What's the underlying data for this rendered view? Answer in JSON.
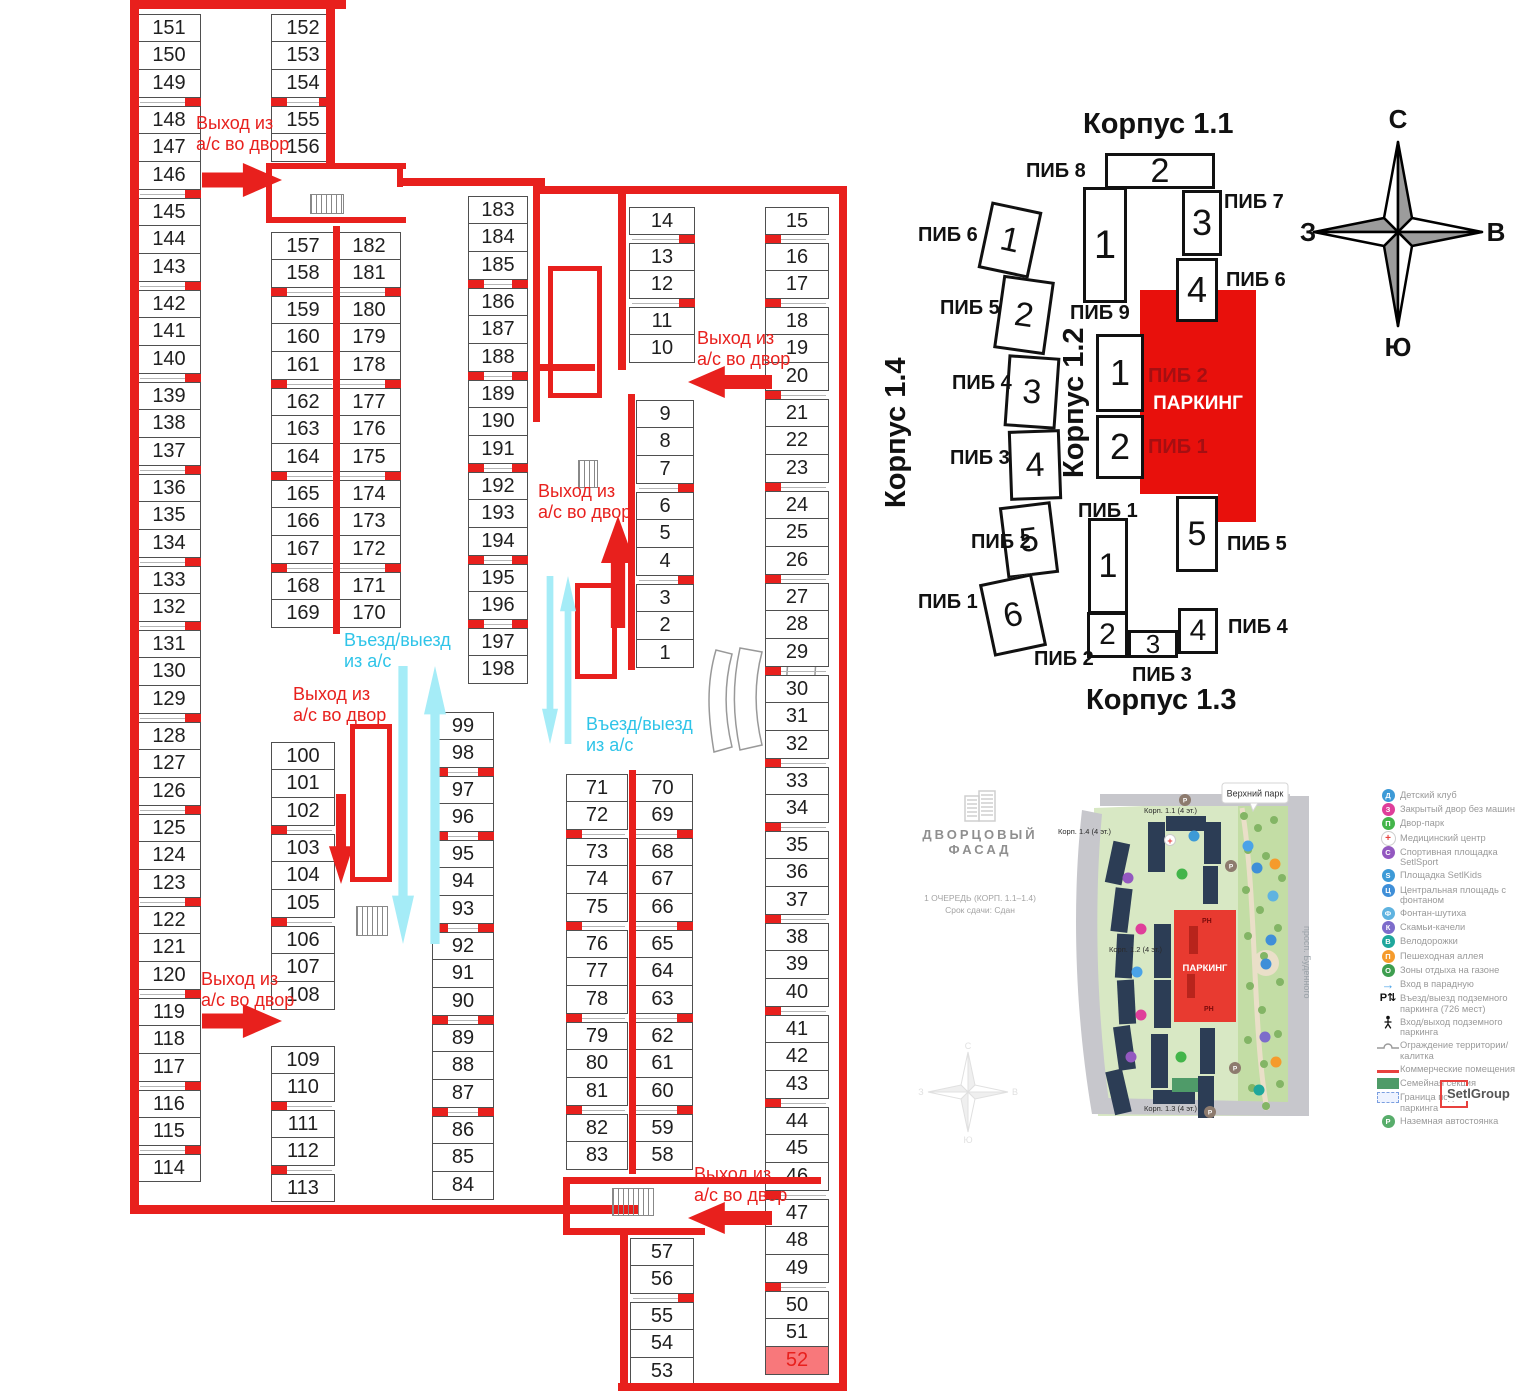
{
  "colors": {
    "wall_red": "#e8201d",
    "cyan_text": "#2fc4e8",
    "cyan_fill": "#a5ecf7",
    "highlight_bg": "#f8787b"
  },
  "floor_plan": {
    "exit_text": "Выход из\nа/с во двор",
    "entry_text": "Въезд/выезд\nиз а/с",
    "highlight": "52",
    "columns": [
      {
        "x": 137,
        "y": 14,
        "w": 64,
        "t": "right",
        "groups": [
          [
            151,
            150,
            149
          ],
          [
            148,
            147,
            146
          ],
          [
            145,
            144,
            143
          ],
          [
            142,
            141,
            140
          ],
          [
            139,
            138,
            137
          ],
          [
            136,
            135,
            134
          ],
          [
            133,
            132
          ],
          [
            131,
            130,
            129
          ],
          [
            128,
            127,
            126
          ],
          [
            125,
            124,
            123
          ],
          [
            122,
            121,
            120
          ],
          [
            119,
            118,
            117
          ],
          [
            116,
            115
          ],
          [
            114
          ]
        ]
      },
      {
        "x": 271,
        "y": 14,
        "w": 64,
        "t": "both",
        "groups": [
          [
            152,
            153,
            154
          ],
          [
            155,
            156
          ]
        ]
      },
      {
        "x": 271,
        "y": 232,
        "w": 64,
        "t": "left",
        "groups": [
          [
            157,
            158
          ],
          [
            159,
            160,
            161
          ],
          [
            162,
            163,
            164
          ],
          [
            165,
            166,
            167
          ],
          [
            168,
            169
          ]
        ]
      },
      {
        "x": 337,
        "y": 232,
        "w": 64,
        "t": "right",
        "groups": [
          [
            182,
            181
          ],
          [
            180,
            179,
            178
          ],
          [
            177,
            176,
            175
          ],
          [
            174,
            173,
            172
          ],
          [
            171,
            170
          ]
        ]
      },
      {
        "x": 271,
        "y": 742,
        "w": 64,
        "t": "left",
        "groups": [
          [
            100,
            101,
            102
          ],
          [
            103,
            104,
            105
          ],
          [
            106,
            107,
            108
          ]
        ]
      },
      {
        "x": 271,
        "y": 1046,
        "w": 64,
        "t": "left",
        "groups": [
          [
            109,
            110
          ],
          [
            111,
            112
          ],
          [
            113
          ]
        ]
      },
      {
        "x": 468,
        "y": 196,
        "w": 60,
        "t": "both",
        "groups": [
          [
            183,
            184,
            185
          ],
          [
            186,
            187,
            188
          ],
          [
            189,
            190,
            191
          ],
          [
            192,
            193,
            194
          ],
          [
            195,
            196
          ],
          [
            197,
            198
          ]
        ]
      },
      {
        "x": 432,
        "y": 712,
        "w": 62,
        "t": "both",
        "groups": [
          [
            99,
            98
          ],
          [
            97,
            96
          ],
          [
            95,
            94,
            93
          ],
          [
            92,
            91,
            90
          ],
          [
            89,
            88,
            87
          ],
          [
            86,
            85,
            84
          ]
        ]
      },
      {
        "x": 629,
        "y": 207,
        "w": 66,
        "t": "right",
        "groups": [
          [
            14
          ],
          [
            13,
            12
          ],
          [
            11,
            10
          ]
        ]
      },
      {
        "x": 636,
        "y": 400,
        "w": 58,
        "t": "right",
        "groups": [
          [
            9,
            8,
            7
          ],
          [
            6,
            5,
            4
          ],
          [
            3,
            2,
            1
          ]
        ]
      },
      {
        "x": 566,
        "y": 774,
        "w": 62,
        "t": "left",
        "groups": [
          [
            71,
            72
          ],
          [
            73,
            74,
            75
          ],
          [
            76,
            77,
            78
          ],
          [
            79,
            80,
            81
          ],
          [
            82,
            83
          ]
        ]
      },
      {
        "x": 632,
        "y": 774,
        "w": 61,
        "t": "right",
        "groups": [
          [
            70,
            69
          ],
          [
            68,
            67,
            66
          ],
          [
            65,
            64,
            63
          ],
          [
            62,
            61,
            60
          ],
          [
            59,
            58
          ]
        ]
      },
      {
        "x": 630,
        "y": 1238,
        "w": 64,
        "t": "right",
        "groups": [
          [
            57,
            56
          ],
          [
            55,
            54,
            53
          ]
        ]
      },
      {
        "x": 765,
        "y": 207,
        "w": 64,
        "t": "left",
        "groups": [
          [
            15
          ],
          [
            16,
            17
          ],
          [
            18,
            19,
            20
          ],
          [
            21,
            22,
            23
          ],
          [
            24,
            25,
            26
          ],
          [
            27,
            28,
            29
          ],
          [
            30,
            31,
            32
          ],
          [
            33,
            34
          ],
          [
            35,
            36,
            37
          ],
          [
            38,
            39,
            40
          ],
          [
            41,
            42,
            43
          ],
          [
            44,
            45,
            46
          ],
          [
            47,
            48,
            49
          ],
          [
            50,
            51,
            52
          ]
        ]
      }
    ],
    "walls": [
      [
        130,
        0,
        216,
        9
      ],
      [
        130,
        0,
        9,
        1214
      ],
      [
        130,
        1205,
        508,
        9
      ],
      [
        326,
        0,
        9,
        166
      ],
      [
        266,
        163,
        140,
        6
      ],
      [
        266,
        217,
        140,
        6
      ],
      [
        266,
        163,
        6,
        60
      ],
      [
        397,
        163,
        6,
        24
      ],
      [
        333,
        226,
        7,
        408
      ],
      [
        400,
        178,
        145,
        8
      ],
      [
        540,
        186,
        306,
        8
      ],
      [
        839,
        186,
        8,
        1205
      ],
      [
        618,
        1383,
        229,
        8
      ],
      [
        533,
        186,
        7,
        236
      ],
      [
        618,
        186,
        8,
        184
      ],
      [
        628,
        394,
        7,
        276
      ],
      [
        533,
        364,
        62,
        7
      ],
      [
        629,
        770,
        7,
        404
      ],
      [
        563,
        1177,
        258,
        7
      ],
      [
        563,
        1177,
        7,
        58
      ],
      [
        563,
        1228,
        142,
        7
      ],
      [
        620,
        1228,
        8,
        160
      ]
    ],
    "rooms": [
      [
        548,
        266,
        54,
        132
      ],
      [
        575,
        583,
        42,
        96
      ],
      [
        350,
        724,
        42,
        158
      ]
    ],
    "stairs": [
      [
        310,
        194,
        34,
        20
      ],
      [
        578,
        460,
        20,
        28
      ],
      [
        356,
        906,
        32,
        30
      ],
      [
        612,
        1188,
        42,
        28
      ]
    ],
    "red_arrows": [
      {
        "x": 202,
        "y": 163,
        "w": 80,
        "h": 34,
        "d": "right"
      },
      {
        "x": 688,
        "y": 366,
        "w": 84,
        "h": 32,
        "d": "left"
      },
      {
        "x": 601,
        "y": 516,
        "w": 34,
        "h": 112,
        "d": "up"
      },
      {
        "x": 329,
        "y": 794,
        "w": 24,
        "h": 90,
        "d": "down"
      },
      {
        "x": 202,
        "y": 1004,
        "w": 80,
        "h": 34,
        "d": "right"
      },
      {
        "x": 688,
        "y": 1202,
        "w": 84,
        "h": 32,
        "d": "left"
      }
    ],
    "red_labels": [
      {
        "x": 196,
        "y": 113
      },
      {
        "x": 697,
        "y": 328
      },
      {
        "x": 538,
        "y": 481
      },
      {
        "x": 293,
        "y": 684
      },
      {
        "x": 201,
        "y": 969
      },
      {
        "x": 694,
        "y": 1164
      }
    ],
    "cyan_arrows": [
      {
        "x": 392,
        "y": 666,
        "w": 22,
        "h": 278,
        "d": "down"
      },
      {
        "x": 424,
        "y": 666,
        "w": 22,
        "h": 278,
        "d": "up"
      },
      {
        "x": 542,
        "y": 576,
        "w": 16,
        "h": 168,
        "d": "down"
      },
      {
        "x": 560,
        "y": 576,
        "w": 16,
        "h": 168,
        "d": "up"
      }
    ],
    "cyan_labels": [
      {
        "x": 344,
        "y": 630
      },
      {
        "x": 586,
        "y": 714
      }
    ]
  },
  "site_diagram": {
    "corpuses": [
      {
        "title": "Корпус 1.1",
        "title_pos": [
          1083,
          108,
          135,
          "h"
        ],
        "sections": [
          {
            "n": "2",
            "x": 1105,
            "y": 153,
            "w": 110,
            "h": 36,
            "r": 0,
            "f": 34
          },
          {
            "n": "1",
            "x": 1083,
            "y": 187,
            "w": 44,
            "h": 116,
            "r": 0,
            "f": 40
          },
          {
            "n": "3",
            "x": 1182,
            "y": 190,
            "w": 40,
            "h": 66,
            "r": 0,
            "f": 36
          },
          {
            "n": "4",
            "x": 1176,
            "y": 258,
            "w": 42,
            "h": 64,
            "r": 0,
            "f": 36
          }
        ],
        "labels": [
          {
            "t": "ПИБ 8",
            "x": 1026,
            "y": 160
          },
          {
            "t": "ПИБ 7",
            "x": 1224,
            "y": 191
          },
          {
            "t": "ПИБ 6",
            "x": 1226,
            "y": 269
          },
          {
            "t": "ПИБ 9",
            "x": 1070,
            "y": 302
          }
        ]
      },
      {
        "title": "Корпус 1.4",
        "title_pos": [
          880,
          508,
          0,
          "v"
        ],
        "sections": [
          {
            "n": "1",
            "x": 984,
            "y": 206,
            "w": 52,
            "h": 68,
            "r": 12,
            "f": 34
          },
          {
            "n": "2",
            "x": 998,
            "y": 278,
            "w": 52,
            "h": 74,
            "r": 8,
            "f": 34
          },
          {
            "n": "3",
            "x": 1006,
            "y": 356,
            "w": 52,
            "h": 72,
            "r": 4,
            "f": 34
          },
          {
            "n": "4",
            "x": 1009,
            "y": 430,
            "w": 52,
            "h": 70,
            "r": -2,
            "f": 34
          },
          {
            "n": "5",
            "x": 1003,
            "y": 504,
            "w": 52,
            "h": 72,
            "r": -7,
            "f": 34
          },
          {
            "n": "6",
            "x": 986,
            "y": 578,
            "w": 54,
            "h": 74,
            "r": -12,
            "f": 34
          }
        ],
        "labels": [
          {
            "t": "ПИБ 6",
            "x": 918,
            "y": 224
          },
          {
            "t": "ПИБ 5",
            "x": 940,
            "y": 297
          },
          {
            "t": "ПИБ 4",
            "x": 952,
            "y": 372
          },
          {
            "t": "ПИБ 3",
            "x": 950,
            "y": 447
          },
          {
            "t": "ПИБ 2",
            "x": 971,
            "y": 531
          },
          {
            "t": "ПИБ 1",
            "x": 918,
            "y": 591
          }
        ]
      },
      {
        "title": "Корпус 1.2",
        "title_pos": [
          1058,
          478,
          0,
          "v"
        ],
        "sections": [
          {
            "n": "1",
            "x": 1096,
            "y": 334,
            "w": 48,
            "h": 78,
            "r": 0,
            "f": 36
          },
          {
            "n": "2",
            "x": 1096,
            "y": 415,
            "w": 48,
            "h": 64,
            "r": 0,
            "f": 36
          }
        ],
        "labels": []
      },
      {
        "title": "Корпус 1.3",
        "title_pos": [
          1086,
          684,
          140,
          "h"
        ],
        "sections": [
          {
            "n": "1",
            "x": 1088,
            "y": 518,
            "w": 40,
            "h": 96,
            "r": 0,
            "f": 34
          },
          {
            "n": "2",
            "x": 1087,
            "y": 612,
            "w": 41,
            "h": 46,
            "r": 0,
            "f": 30
          },
          {
            "n": "3",
            "x": 1128,
            "y": 630,
            "w": 50,
            "h": 28,
            "r": 0,
            "f": 26
          },
          {
            "n": "4",
            "x": 1178,
            "y": 608,
            "w": 40,
            "h": 46,
            "r": 0,
            "f": 30
          },
          {
            "n": "5",
            "x": 1176,
            "y": 496,
            "w": 42,
            "h": 76,
            "r": 0,
            "f": 34
          }
        ],
        "labels": [
          {
            "t": "ПИБ 1",
            "x": 1078,
            "y": 500
          },
          {
            "t": "ПИБ 5",
            "x": 1227,
            "y": 533
          },
          {
            "t": "ПИБ 4",
            "x": 1228,
            "y": 616
          },
          {
            "t": "ПИБ 3",
            "x": 1132,
            "y": 664
          },
          {
            "t": "ПИБ 2",
            "x": 1034,
            "y": 648
          }
        ]
      }
    ],
    "parking": {
      "label": "ПАРКИНГ",
      "polygon": [
        [
          1140,
          290
        ],
        [
          1256,
          290
        ],
        [
          1256,
          522
        ],
        [
          1218,
          522
        ],
        [
          1218,
          494
        ],
        [
          1140,
          494
        ]
      ],
      "labels": [
        {
          "t": "ПИБ 2",
          "x": 1148,
          "y": 365
        },
        {
          "t": "ПИБ 1",
          "x": 1148,
          "y": 436
        }
      ]
    }
  },
  "compass": {
    "n": "С",
    "e": "В",
    "s": "Ю",
    "w": "З"
  },
  "master_plan": {
    "callout": "Верхний парк",
    "street": "просп. Буденного",
    "korp11": "Корп. 1.1 (4 эт.)",
    "korp12": "Корп. 1.2 (4 эт.)",
    "korp13": "Корп. 1.3 (4 эт.)",
    "korp14": "Корп. 1.4 (4 эт.)",
    "parking_label": "ПАРКИНГ",
    "ph": "РН"
  },
  "brand": {
    "line1": "ДВОРЦОВЫЙ",
    "line2": "ФАСАД",
    "sub1": "1 ОЧЕРЕДЬ (КОРП. 1.1–1.4)",
    "sub2": "Срок сдачи: Сдан"
  },
  "setl": "SetlGroup",
  "legend": {
    "items": [
      {
        "label": "Детский клуб",
        "icon": {
          "kind": "circle",
          "c": "#3d9ad7",
          "g": "Д"
        }
      },
      {
        "label": "Закрытый двор без машин",
        "icon": {
          "kind": "circle",
          "c": "#df3f9a",
          "g": "З"
        }
      },
      {
        "label": "Двор-парк",
        "icon": {
          "kind": "circle",
          "c": "#43b54a",
          "g": "П"
        }
      },
      {
        "label": "Медицинский центр",
        "icon": {
          "kind": "med",
          "g": "+"
        }
      },
      {
        "label": "Спортивная площадка SetlSport",
        "icon": {
          "kind": "circle",
          "c": "#9358c0",
          "g": "С"
        }
      },
      {
        "label": "Площадка SetlKids",
        "icon": {
          "kind": "circle",
          "c": "#3d9ad7",
          "g": "S"
        }
      },
      {
        "label": "Центральная площадь с фонтаном",
        "icon": {
          "kind": "circle",
          "c": "#3f8fd8",
          "g": "Ц"
        }
      },
      {
        "label": "Фонтан-шутиха",
        "icon": {
          "kind": "circle",
          "c": "#5fb3e0",
          "g": "Ф"
        }
      },
      {
        "label": "Скамьи-качели",
        "icon": {
          "kind": "circle",
          "c": "#7d6ccb",
          "g": "К"
        }
      },
      {
        "label": "Велодорожки",
        "icon": {
          "kind": "circle",
          "c": "#1fa79c",
          "g": "В"
        }
      },
      {
        "label": "Пешеходная аллея",
        "icon": {
          "kind": "circle",
          "c": "#f59b2c",
          "g": "П"
        }
      },
      {
        "label": "Зоны отдыха на газоне",
        "icon": {
          "kind": "circle",
          "c": "#3e9e4f",
          "g": "О"
        }
      },
      {
        "label": "Вход в парадную",
        "icon": {
          "kind": "arrow",
          "g": "→"
        }
      },
      {
        "label": "Въезд/выезд подземного паркинга (726 мест)",
        "icon": {
          "kind": "pn",
          "g": "Р⇅"
        }
      },
      {
        "label": "Вход/выход подземного паркинга",
        "icon": {
          "kind": "walk"
        }
      },
      {
        "label": "Ограждение территории/калитка",
        "icon": {
          "kind": "fence"
        }
      },
      {
        "label": "Коммерческие помещения",
        "icon": {
          "kind": "line",
          "c": "#e8413e"
        }
      },
      {
        "label": "Семейная секция",
        "icon": {
          "kind": "rect",
          "c": "#4e9b68"
        }
      },
      {
        "label": "Граница подземного паркинга",
        "icon": {
          "kind": "dash",
          "c": "#7b9fe0"
        }
      },
      {
        "label": "Наземная автостоянка",
        "icon": {
          "kind": "circle",
          "c": "#58ad6b",
          "g": "Р"
        }
      }
    ]
  }
}
